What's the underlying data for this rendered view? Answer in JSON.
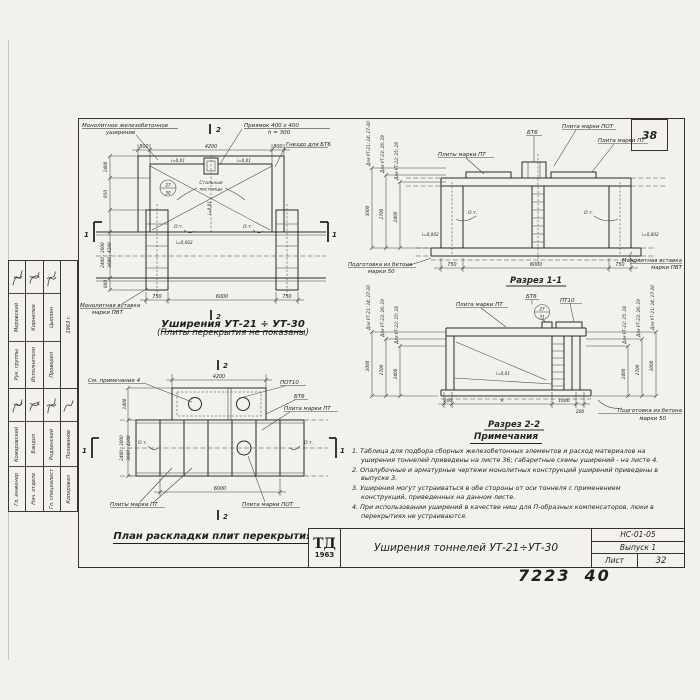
{
  "sheet": {
    "corner_number": "38",
    "doc_code": "НС-01-05",
    "issue": "Выпуск 1",
    "sheet_label": "Лист",
    "sheet_number": "32",
    "logo_top": "ТД",
    "logo_year": "1963",
    "title": "Уширения тоннелей УТ-21÷УТ-30",
    "handwritten_left": "7223",
    "handwritten_right": "40"
  },
  "plan_widening": {
    "title": "Уширения УТ-21 ÷ УТ-30",
    "subtitle": "(Плиты перекрытия не показаны)",
    "labels": {
      "monolithic_line1": "Монолитное железобетонное",
      "monolithic_line2": "уширение",
      "pit_line1": "Приямок 400 x 400",
      "pit_line2": "h = 300",
      "socket": "Гнездо для БТ6",
      "ladders_line1": "Стальные",
      "ladders_line2": "лестницы",
      "insert_line1": "Монолитная вставка",
      "insert_line2": "марки ПВТ",
      "axis_left": "О.т.",
      "axis_right": "О.т.",
      "slope_left": "i=0,01",
      "slope_right": "i=0,01",
      "slope_mid": "i=0,01",
      "slope_bottom": "i=0,002",
      "balloon_top": "27",
      "balloon_bottom": "30",
      "section_top": "2",
      "section_bottom": "2",
      "section_left": "1",
      "section_right": "1"
    },
    "dims": {
      "top_left": "800",
      "top_center": "4200",
      "top_right": "800",
      "bottom_left": "750",
      "bottom_center": "6000",
      "bottom_right": "750",
      "left_1": "1400",
      "left_2": "950",
      "left_3": "2400 ; 3000",
      "left_4": "3600 ; 4200",
      "left_5": "800"
    }
  },
  "section_1_1": {
    "title": "Разрез 1-1",
    "labels": {
      "plates_pt_left": "Плиты марки ПТ",
      "bt6": "БТ6",
      "plate_pot": "Плита марки ПОТ",
      "plate_pt_right": "Плита марки ПТ",
      "prep_line1": "Подготовка из бетона",
      "prep_line2": "марки 50",
      "insert_line1": "Монолитная вставка",
      "insert_line2": "марки ПВТ",
      "axis_left": "О.т.",
      "axis_right": "О.т.",
      "slope_left": "i=0,002",
      "slope_right": "i=0,002"
    },
    "height_chains": [
      {
        "label": "Для УТ-21; 24; 27-30",
        "value": "3000"
      },
      {
        "label": "Для УТ-23; 26; 29",
        "value": "2700"
      },
      {
        "label": "Для УТ-22; 25; 28",
        "value": "2400"
      }
    ],
    "dims": {
      "bottom_left": "750",
      "bottom_center": "6000",
      "bottom_right": "750"
    }
  },
  "section_2_2": {
    "title": "Разрез 2-2",
    "labels": {
      "plate_pt": "Плита марки ПТ",
      "bt6": "БТ6",
      "pt10": "ПТ10",
      "slope": "i=0,01",
      "balloon_top": "27",
      "balloon_bottom": "31",
      "prep_line1": "Подготовка из бетона",
      "prep_line2": "марки 50"
    },
    "height_chains_left": [
      {
        "label": "Для УТ-21; 24; 27-30",
        "value": "3000"
      },
      {
        "label": "Для УТ-23; 26; 29",
        "value": "2700"
      },
      {
        "label": "Для УТ-22; 25; 28",
        "value": "2400"
      }
    ],
    "height_chains_right": [
      {
        "label": "Для УТ-22; 25; 28",
        "value": "2400"
      },
      {
        "label": "Для УТ-23; 26; 29",
        "value": "2700"
      },
      {
        "label": "Для УТ-21; 24; 27-30",
        "value": "3000"
      }
    ],
    "dims": {
      "b1": "200",
      "b2": "А",
      "b3": "1000",
      "b4": "200"
    }
  },
  "plan_slabs": {
    "title": "План раскладки плит перекрытия",
    "labels": {
      "see_note": "См. примечание 4",
      "pot10": "ПОТ10",
      "bt6": "БТ6",
      "plate_pt": "Плита марки ПТ",
      "plates_pt": "Плиты марки ПТ",
      "plate_pot": "Плита марки ПОТ",
      "axis_left": "О.т.",
      "axis_right": "О.т.",
      "section_top": "2",
      "section_bottom": "2",
      "section_left": "1",
      "section_right": "1"
    },
    "dims": {
      "top": "4200",
      "left_upper": "1400",
      "left_lower_1": "2400 ; 3000",
      "left_lower_2": "3600 ; 4200",
      "bottom": "6000"
    }
  },
  "notes": {
    "heading": "Примечания",
    "items": [
      "1. Таблица для подбора сборных железобетонных элементов и расход материалов на уширения тоннелей приведены на листе 36; габаритные схемы уширений - на листе 4.",
      "2. Опалубочные и арматурные чертежи монолитных конструкций уширений приведены в выпуске 3.",
      "3. Уширения могут устраиваться в обе стороны от оси тоннеля с применением конструкций, приведенных на данном листе.",
      "4. При использовании уширений в качестве ниш для П-образных компенсаторов, люки в перекрытиях не устраиваются."
    ]
  },
  "left_stamp": {
    "date": "1963 г.",
    "group1": [
      {
        "role": "Рук. группы",
        "name": "Мировский"
      },
      {
        "role": "Исполнители",
        "name": "Корнилюк"
      },
      {
        "role": "Проверил",
        "name": "Цыплин"
      }
    ],
    "group2": [
      {
        "role": "Гл. инженер",
        "name": "Комаровский"
      },
      {
        "role": "Нач. отдела",
        "name": "Бандол"
      },
      {
        "role": "Гл. специалист",
        "name": "Родзинский"
      },
      {
        "role": "Копировал",
        "name": "Поливанов"
      }
    ]
  }
}
